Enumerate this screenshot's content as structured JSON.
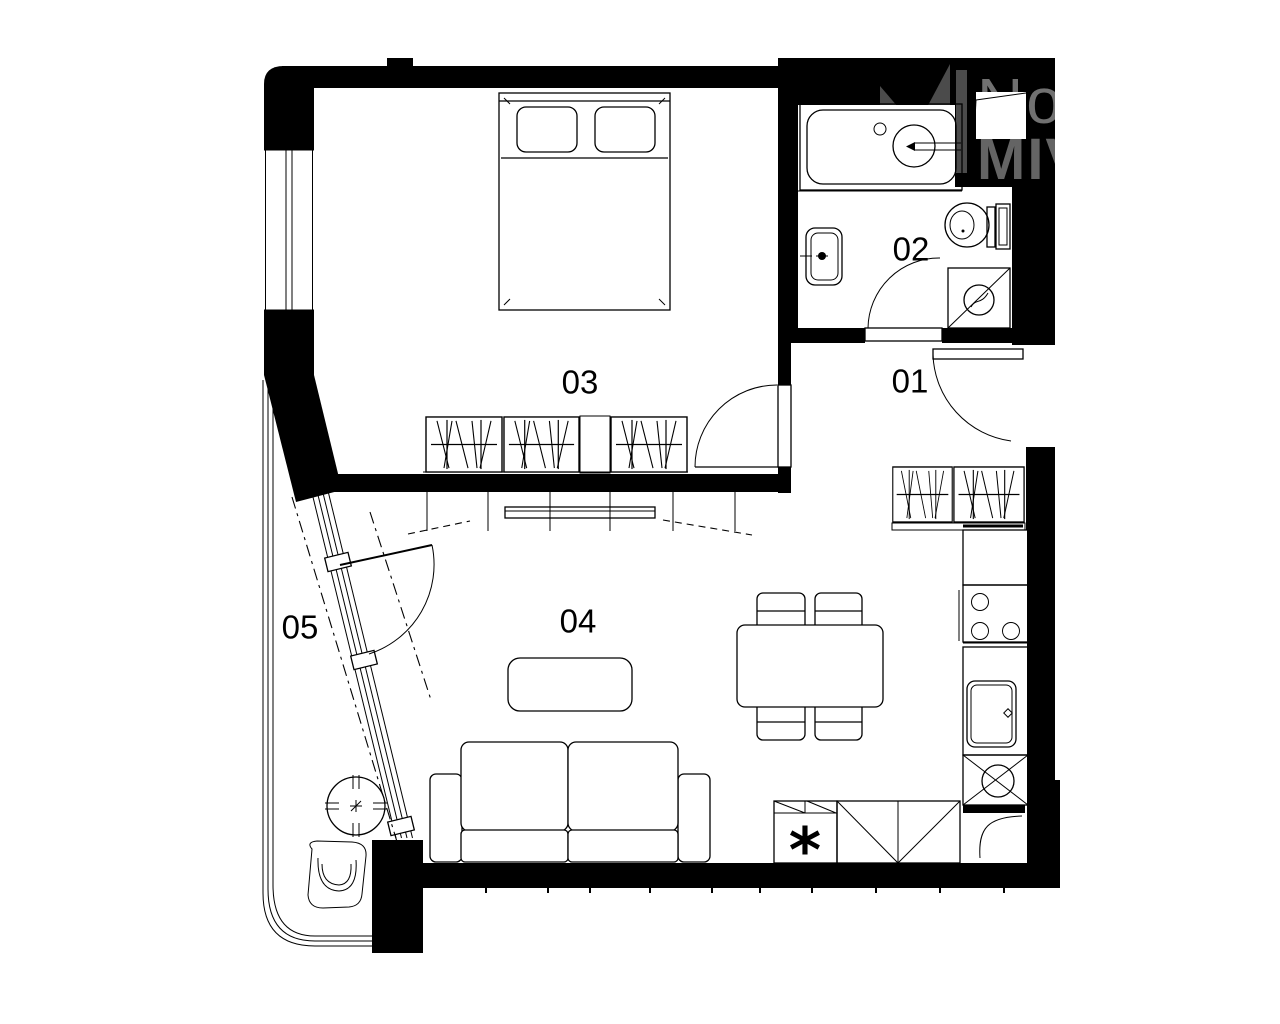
{
  "page": {
    "background": "#ffffff",
    "ink": "#000000"
  },
  "rooms": [
    {
      "id": "01",
      "label": "01",
      "name": "hallway"
    },
    {
      "id": "02",
      "label": "02",
      "name": "bathroom"
    },
    {
      "id": "03",
      "label": "03",
      "name": "bedroom"
    },
    {
      "id": "04",
      "label": "04",
      "name": "living-room-with-kitchen"
    },
    {
      "id": "05",
      "label": "05",
      "name": "balcony"
    }
  ],
  "watermark": {
    "line1": "No",
    "line2": "MIV",
    "logo_color": "#4b4b4b",
    "text_color_light": "#717171",
    "text_color_bold": "#646464"
  },
  "kitchen": {
    "freezer_mark": "*"
  }
}
